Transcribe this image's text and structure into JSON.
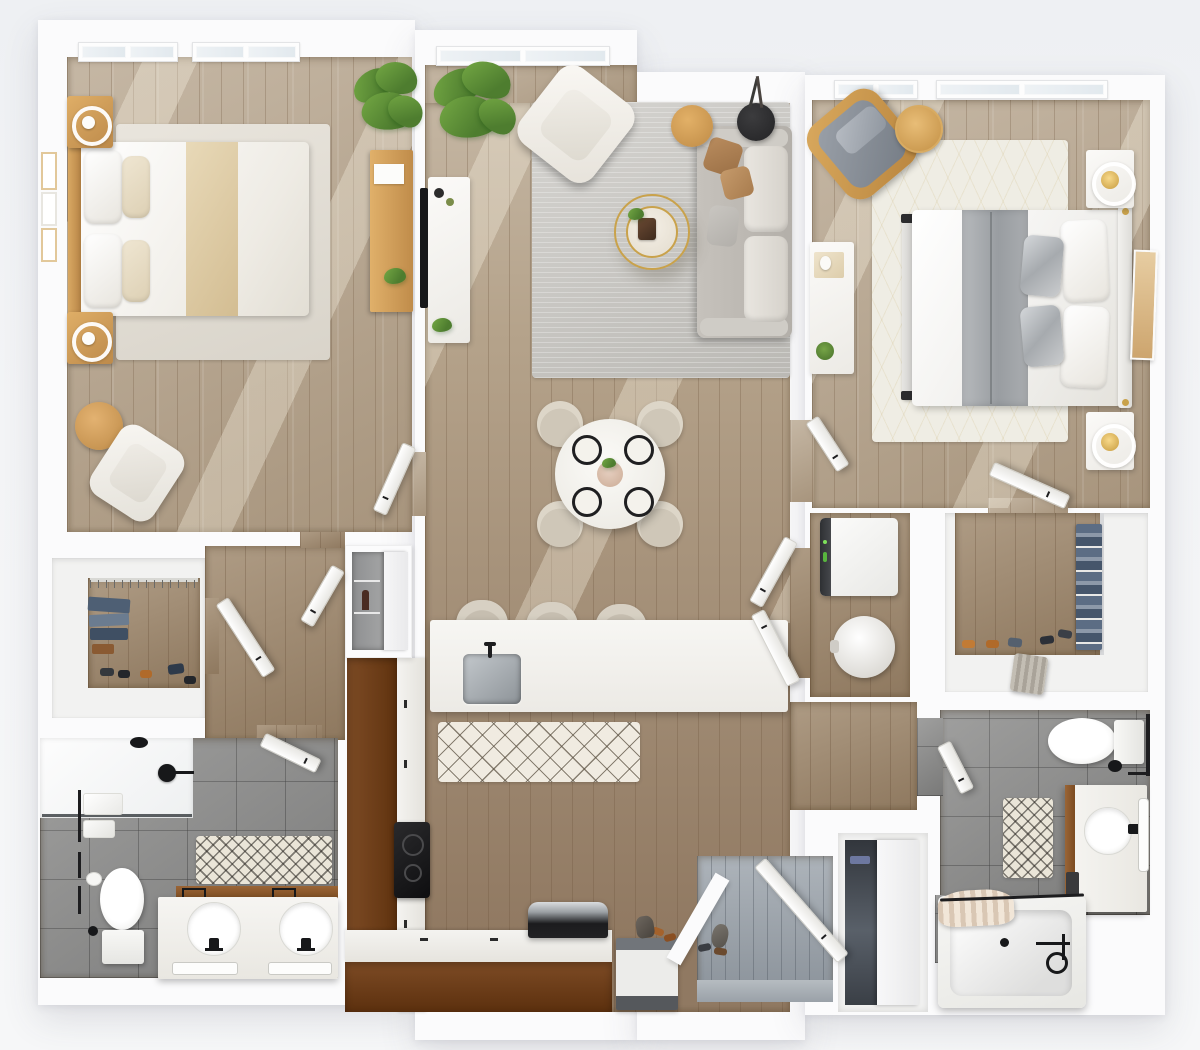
{
  "meta": {
    "title": "Two-bedroom, two-bath apartment floor plan — 3D top-down rendering",
    "view": "top-down",
    "text_labels": "none visible"
  },
  "palette": {
    "bg": "#f2f3f6",
    "wall": "#fbfbfc",
    "wood-light": "#b5a38b",
    "wood-mid": "#a08a6f",
    "wood-dark": "#8a7258",
    "counter": "#6f4220",
    "entry": "#9ba3ab",
    "tile": "#8d8d8c",
    "rug-gray": "#c8c6c1",
    "rug-cream": "#efeadf",
    "rug-white": "#efede4",
    "sofa": "#bdb9b3",
    "chair": "#dcd5c7",
    "wood-accent": "#cf9e55",
    "steel": "#aeb4b8",
    "green": "#4e7d2f",
    "green-2": "#74a844",
    "black": "#1d1d1f",
    "gold": "#c9a24b",
    "denim": "#5c6d84"
  },
  "rooms": [
    {
      "name": "bedroom-1",
      "position": "top-left",
      "furniture": [
        "double-bed-with-tan-runner",
        "wood-headboard",
        "nightstand-with-round-lamp x2",
        "wall-frames x3",
        "area-rug",
        "accent-armchair",
        "round-side-table",
        "desk-with-paper",
        "potted-plant",
        "windows x2"
      ]
    },
    {
      "name": "living-dining-kitchen",
      "position": "center",
      "furniture": [
        "tv-console",
        "wall-tv",
        "large-plant",
        "white-armchair",
        "gray-sofa-with-pillows",
        "gold-coffee-table",
        "wood-side-table",
        "black-side-table",
        "gray-area-rug",
        "round-dining-table-4-settings",
        "dining-chairs x4",
        "kitchen-island-with-sink",
        "bar-stools x3",
        "diamond-pattern-runner",
        "l-shaped-counter",
        "cooktop",
        "range-oven",
        "dishwasher",
        "window"
      ]
    },
    {
      "name": "bedroom-2",
      "position": "top-right",
      "furniture": [
        "double-bed-gray-duvet",
        "upholstered-headboard",
        "foot-bench",
        "nightstand-with-gold-lamp x2",
        "leaning-artwork",
        "gray-wood-frame-armchair",
        "round-side-table",
        "dresser-with-decor",
        "patterned-white-rug",
        "windows x2"
      ]
    },
    {
      "name": "walk-in-closet-1",
      "position": "middle-left",
      "furniture": [
        "hanging-rod",
        "folded-denim",
        "shoe-row"
      ]
    },
    {
      "name": "bathroom-1",
      "position": "bottom-left",
      "furniture": [
        "glass-shower",
        "shower-head",
        "towel-bars",
        "toilet",
        "double-vanity-two-sinks",
        "mirror-light-bars",
        "chevron-bath-mat"
      ]
    },
    {
      "name": "linen-closet",
      "position": "center-left",
      "furniture": [
        "mirrored-sliding-door",
        "shelves"
      ]
    },
    {
      "name": "laundry-closet",
      "position": "center-right",
      "furniture": [
        "washing-machine",
        "round-hamper",
        "double-doors"
      ]
    },
    {
      "name": "walk-in-closet-2",
      "position": "center-right",
      "furniture": [
        "hanging-clothes",
        "shoe-row",
        "laundry-basket"
      ]
    },
    {
      "name": "bathroom-2",
      "position": "bottom-right",
      "furniture": [
        "toilet",
        "single-vanity",
        "mirror-light-bar",
        "chevron-bath-mat",
        "bathtub-with-curtain",
        "towel-bar"
      ]
    },
    {
      "name": "entry",
      "position": "bottom-center",
      "furniture": [
        "entry-door",
        "shoes",
        "decor-vase",
        "gray-wood-floor"
      ]
    },
    {
      "name": "coat-closet",
      "position": "bottom-center",
      "furniture": [
        "sliding-door",
        "hanging-coats"
      ]
    }
  ]
}
